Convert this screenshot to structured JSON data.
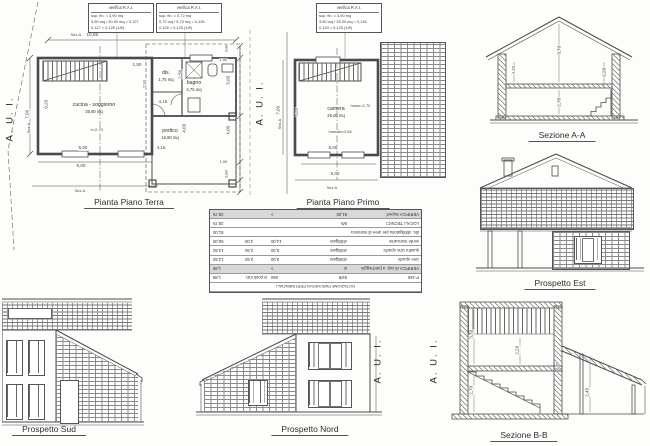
{
  "aui_label": "A. U. I.",
  "stamps": [
    {
      "title": "verifica R.A.I.",
      "l1": "sup. fin. = 3,90 mq",
      "l2": "3,90 mq / 30,50 mq = 0,127",
      "l3": "0,127 > 0,125 (1/8)"
    },
    {
      "title": "verifica R.A.I.",
      "l1": "sup. fin. = 0,72 mq",
      "l2": "0,72 mq / 5,70 mq = 0,126",
      "l3": "0,126 > 0,125 (1/8)"
    },
    {
      "title": "verifica R.A.I.",
      "l1": "sup. fin. = 3,50 mq",
      "l2": "3,50 mq / 26,00 mq = 0,134",
      "l3": "0,134 > 0,125 (1/8)"
    }
  ],
  "terra": {
    "title": "Pianta Piano Terra",
    "room_cucina": "cucina - soggiorno",
    "room_cucina_area": "35,80 mq",
    "room_cucina_h": "h=2,70",
    "room_dis": "dis.",
    "room_dis_area": "1,75 mq",
    "room_bagno": "bagno",
    "room_bagno_area": "4,75 mq",
    "room_portico": "portico",
    "room_portico_area": "16,60 mq",
    "dim_top": "10,05",
    "dim_left": "9,20",
    "dim_left2": "7,00",
    "dim_150": "1,50",
    "dim_415a": "4,15",
    "dim_415b": "4,15",
    "dim_500a": "5,00",
    "dim_500b": "5,00",
    "dim_250": "2,50",
    "dim_290": "2,90",
    "dim_400p": "4,00",
    "dim_r080a": "0,80",
    "dim_r100a": "1,00",
    "dim_r300": "3,00",
    "dim_r400": "4,00",
    "dim_r100b": "1,00",
    "dim_r080b": "0,80",
    "sez": "Sez.A"
  },
  "primo": {
    "title": "Pianta Piano Primo",
    "room_camera": "camera",
    "room_camera_area": "26,00 mq",
    "hmax": "hmax=2,70",
    "hmedia": "hmedia=2,56",
    "dim_520": "5,20",
    "dim_500": "5,00",
    "dim_500b": "5,00",
    "dim_700": "7,00",
    "sez": "Sez.A"
  },
  "sezA": {
    "title": "Sezione A-A",
    "d370": "3,70",
    "d220": "2,20",
    "d270": "2,70",
    "d120": "1,20"
  },
  "est": {
    "title": "Prospetto Est"
  },
  "sud": {
    "title": "Prospetto Sud"
  },
  "nord": {
    "title": "Prospetto Nord"
  },
  "sezB": {
    "title": "Sezione B-B",
    "d370": "3,70",
    "d220": "2,20",
    "d270": "2,70",
    "d245": "2,45",
    "d030": "0,30"
  },
  "table": {
    "title": "DOTAZIONE PARCHEGGI PERTINENZIALI",
    "rows": [
      {
        "c": [
          "P-160",
          "92/8",
          "060",
          "in posti min.",
          "1,88"
        ]
      },
      {
        "c": [
          "VERIFICA di sup. a parcheggio",
          "si",
          ">",
          "",
          "1,88"
        ]
      },
      {
        "c": [
          "cine opachi",
          "obbligato",
          "5,00",
          "2,50",
          "12,50"
        ]
      },
      {
        "c": [
          "quadro cine opachi",
          "obbligato",
          "5,00",
          "2,50",
          "12,50"
        ]
      },
      {
        "c": [
          "verde mancante",
          "obbligato",
          "14,00",
          "4,00",
          "56,00"
        ]
      },
      {
        "c": [
          "dis. obbligatoria per aree di manovra",
          "",
          "",
          "",
          "81,00"
        ]
      },
      {
        "c": [
          "LOCALI TECNICI",
          "9/5",
          "",
          "",
          "28,76"
        ]
      },
      {
        "c": [
          "VERIFICA Superf.",
          "81,00",
          ">",
          "",
          "28,76"
        ]
      }
    ]
  }
}
